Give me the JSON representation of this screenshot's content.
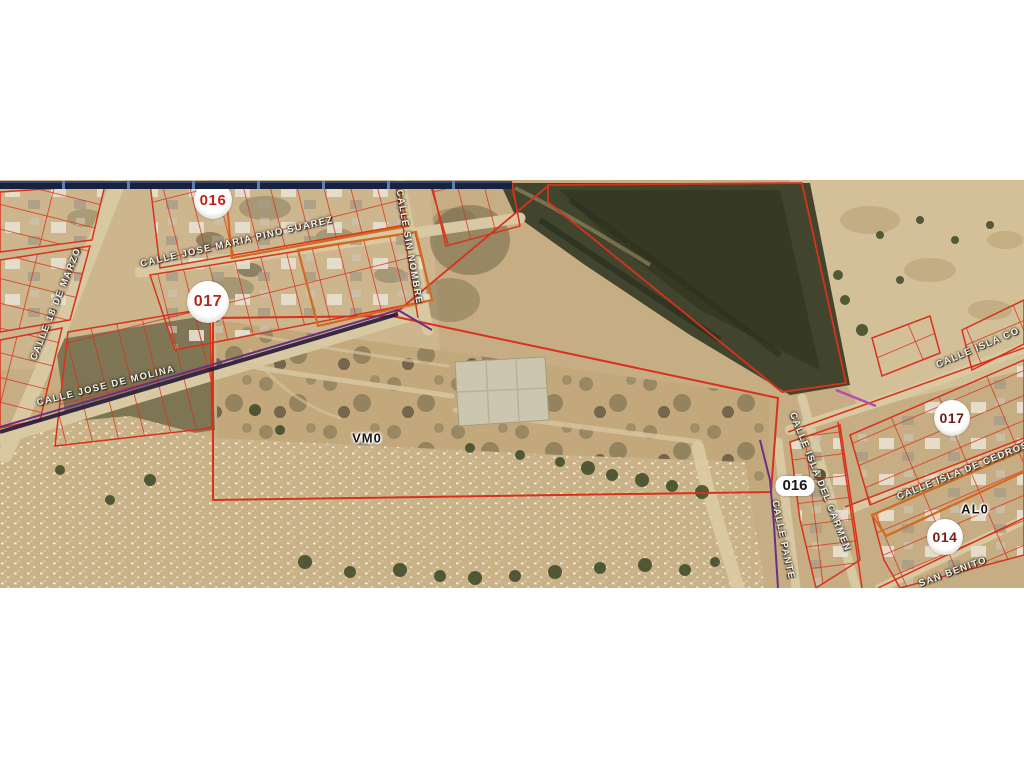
{
  "map": {
    "streets": [
      {
        "id": "calle-18-de-marzo",
        "name": "CALLE 18 DE MARZO"
      },
      {
        "id": "calle-jose-maria-pino-suarez",
        "name": "CALLE JOSE MARIA PINO SUAREZ"
      },
      {
        "id": "calle-jose-de-molina",
        "name": "CALLE JOSE DE MOLINA"
      },
      {
        "id": "calle-sin-nombre",
        "name": "CALLE SIN NOMBRE"
      },
      {
        "id": "calle-isla-co",
        "name": "CALLE ISLA CO"
      },
      {
        "id": "calle-isla-de-cedros",
        "name": "CALLE ISLA DE CEDROS"
      },
      {
        "id": "calle-isla-del-carmen",
        "name": "CALLE ISLA DEL CARMEN"
      },
      {
        "id": "calle-pante",
        "name": "CALLE PANTE"
      },
      {
        "id": "san-benito",
        "name": "SAN BENITO"
      }
    ],
    "markers": [
      {
        "id": "zone-016-left",
        "label": "016",
        "text_color": "#c02315"
      },
      {
        "id": "zone-017-left",
        "label": "017",
        "text_color": "#b5251a"
      },
      {
        "id": "zone-017-right",
        "label": "017",
        "text_color": "#6e1c12"
      },
      {
        "id": "zone-016-right",
        "label": "016",
        "text_color": "#181818"
      },
      {
        "id": "zone-014",
        "label": "014",
        "text_color": "#7a2017"
      },
      {
        "id": "zone-al0",
        "label": "AL0",
        "text_color": "#151515"
      },
      {
        "id": "zone-vm0",
        "label": "VM0",
        "text_color": "#151515"
      }
    ],
    "colors": {
      "parcel_line": "#d8321b",
      "block_outline_orange": "#d4691f",
      "boundary_purple": "#6b2f86",
      "boundary_magenta": "#b44cb0",
      "terrain_tan": "#c7ad83",
      "ravine_dark": "#41452d",
      "header_band": "#18223f"
    }
  }
}
